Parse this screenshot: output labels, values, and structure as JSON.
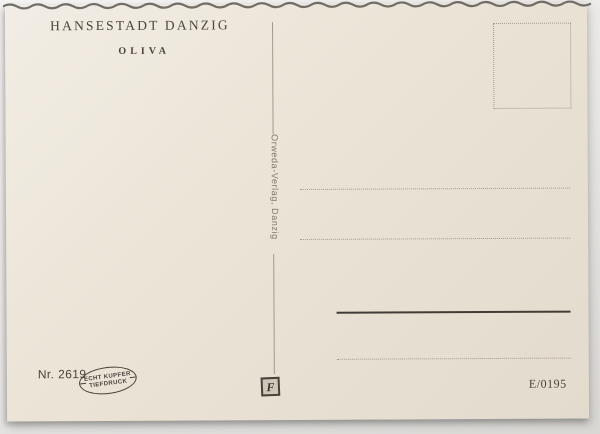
{
  "postcard": {
    "title": "HANSESTADT DANZIG",
    "subtitle": "OLIVA",
    "publisher": "Orweda-Verlag, Danzig",
    "card_number": "Nr. 2619",
    "print_mark": {
      "line1": "ECHT KUPFER",
      "line2": "TIEFDRUCK"
    },
    "logo_letter": "F",
    "code": "E/0195"
  },
  "colors": {
    "card_bg": "#ebe4d7",
    "ink": "#4a443c",
    "muted_ink": "#7e776b",
    "faint_line": "#a29a8c",
    "strong_line": "#413d36",
    "stamp_ink": "#46423c",
    "scan_background": "#e9e8e6"
  }
}
